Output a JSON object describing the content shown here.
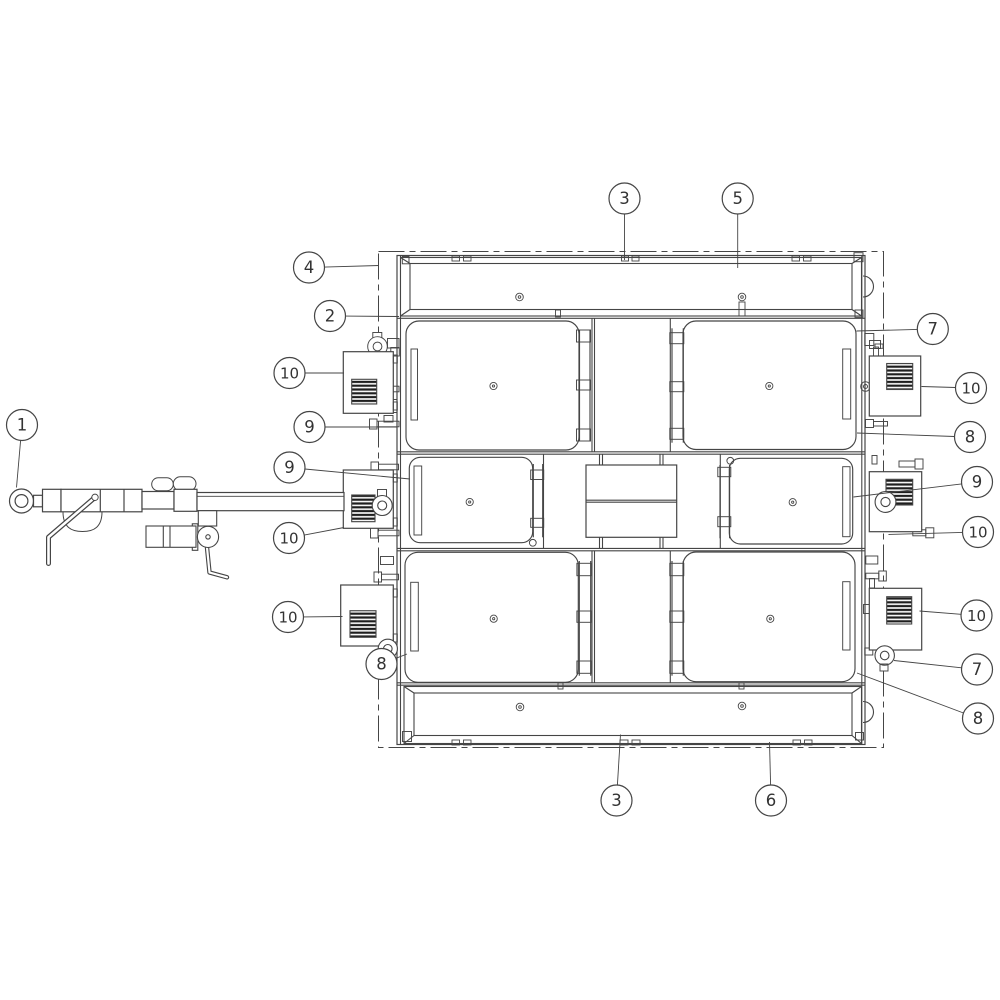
{
  "diagram": {
    "colors": {
      "background": "#ffffff",
      "line": "#454545",
      "grille": "#1e1e1e",
      "balloon_text": "#333333"
    },
    "balloon_radius": 15.5,
    "callouts": [
      {
        "label": "1",
        "cx": 22,
        "cy": 425,
        "tx": 16.5,
        "ty": 487.5
      },
      {
        "label": "4",
        "cx": 309,
        "cy": 267.5,
        "tx": 379,
        "ty": 265.5
      },
      {
        "label": "2",
        "cx": 330,
        "cy": 316,
        "tx": 399,
        "ty": 316.5
      },
      {
        "label": "10",
        "cx": 289.5,
        "cy": 373,
        "tx": 344,
        "ty": 373
      },
      {
        "label": "9",
        "cx": 309.5,
        "cy": 427,
        "tx": 397,
        "ty": 427
      },
      {
        "label": "9",
        "cx": 289.5,
        "cy": 467.5,
        "tx": 410,
        "ty": 479
      },
      {
        "label": "10",
        "cx": 289,
        "cy": 538,
        "tx": 344,
        "ty": 527.5
      },
      {
        "label": "10",
        "cx": 288,
        "cy": 617,
        "tx": 342.5,
        "ty": 616.5
      },
      {
        "label": "8",
        "cx": 381.5,
        "cy": 664,
        "tx": 407,
        "ty": 654
      },
      {
        "label": "3",
        "cx": 624.5,
        "cy": 198.5,
        "tx": 624.5,
        "ty": 260
      },
      {
        "label": "5",
        "cx": 737.7,
        "cy": 198.5,
        "tx": 737.7,
        "ty": 268
      },
      {
        "label": "7",
        "cx": 932.8,
        "cy": 329,
        "tx": 856.5,
        "ty": 331
      },
      {
        "label": "10",
        "cx": 971,
        "cy": 388,
        "tx": 921.5,
        "ty": 386.5
      },
      {
        "label": "8",
        "cx": 970,
        "cy": 437,
        "tx": 857,
        "ty": 433
      },
      {
        "label": "9",
        "cx": 977,
        "cy": 482,
        "tx": 853.5,
        "ty": 497
      },
      {
        "label": "10",
        "cx": 978,
        "cy": 532,
        "tx": 888.5,
        "ty": 534.5
      },
      {
        "label": "10",
        "cx": 976.5,
        "cy": 615.5,
        "tx": 919.5,
        "ty": 611
      },
      {
        "label": "7",
        "cx": 977,
        "cy": 669.5,
        "tx": 894,
        "ty": 660.5
      },
      {
        "label": "8",
        "cx": 978,
        "cy": 718.5,
        "tx": 857,
        "ty": 673
      },
      {
        "label": "3",
        "cx": 616.5,
        "cy": 800.5,
        "tx": 620.5,
        "ty": 734.5
      },
      {
        "label": "6",
        "cx": 771,
        "cy": 800.5,
        "tx": 769.5,
        "ty": 742
      }
    ]
  }
}
